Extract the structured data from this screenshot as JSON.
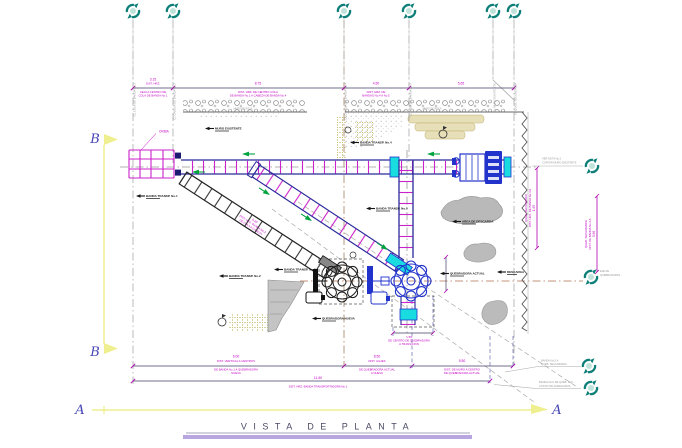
{
  "title": {
    "text": "VISTA  DE  PLANTA"
  },
  "sections": {
    "b_top": "B",
    "b_bottom": "B",
    "a_left": "A",
    "a_right": "A"
  },
  "axes_top": {
    "a0": "CL COLA DE BANDA No.1",
    "a1": "CL CABEZA DE BANDA No.2",
    "a2": "CL CABEZA DE BANDA No.4",
    "a3": "CL COLA DE BANDA No.5",
    "a4": "CL MURO EXISTENTE",
    "a5": "CL QUEB. SECUNDARIA"
  },
  "dims_top": {
    "d0": {
      "value": "3.15",
      "l1": "DIST. HRZ.",
      "l2": "CEJA A CENTRO DE",
      "l3": "COLA DE BANDA No.1"
    },
    "d1": {
      "value": "8.75",
      "l1": "DIST. HRZ. DE CENTRO COLA",
      "l2": "DE BANDA No.1 A CABEZA DE BANDA No.4"
    },
    "d2": {
      "value": "4.50",
      "l1": "DIST. HRZ. DE",
      "l2": "BANDAS No.4 A No.5"
    },
    "d3": {
      "value": "5.65"
    }
  },
  "dims_bottom": {
    "b0": {
      "value": "6.00",
      "l1": "DIST. VERTICAL A CENTROS",
      "l2": "DE BANDA No.1 A QUEBRADORA",
      "l3": "NUEVA"
    },
    "b1": {
      "value": "8.50",
      "l1": "DIST. A EJES",
      "l2": "DE QUEBRADORA ACTUAL",
      "l3": "A NUEVA"
    },
    "b2": {
      "value": "5.50",
      "l1": "DIST. DE MURO A CENTRO",
      "l2": "DE QUEBRADORA ACTUAL"
    },
    "b3": {
      "value": "11.60",
      "l1": "DIST. HRZ. BANDA TRANSPORTADORA No.1"
    }
  },
  "dims_right": {
    "r0": {
      "value": "1.95",
      "l1": "DIST. HRZ. DE BANDA No.4 A",
      "l2": "QUEB. SECUNDARIA"
    },
    "r1": {
      "value": "3.96",
      "l1": "DIST. DE BANDA No.4 A",
      "l2": "QUEB. SECUNDARIA"
    }
  },
  "dim_diag": {
    "value": "9.20",
    "l1": "DIST. HRZ. BANDA No.2",
    "l2": "DE COLA A CABEZA"
  },
  "dim_transition": {
    "value": "1.50",
    "l1": "DE CENTRO DE QUEBRADORA",
    "l2": "A TRANSICION"
  },
  "tags": {
    "t0": "MURO EXISTENTE",
    "t1": "BANDA TRANSP. No.4",
    "t2": "BANDA TRANSP. No.1",
    "t3": "AREA DE DESCARGA",
    "t4": "BANDA TRANSP. No.5",
    "t5": "BANDA TRANSP. No.2",
    "t6": "BANDA TRANSP. No.3",
    "t7": "QUEBRADORA NUEVA",
    "t8": "QUEBRADORA ACTUAL",
    "t9": "DESCARGA"
  },
  "notes": {
    "n0": {
      "l1": "VER NOTA No.2",
      "l2": "CORTAR MURO EXISTENTE"
    },
    "n1": {
      "l1": "EJE DE",
      "l2": "QUEBRADORAS"
    },
    "n2": {
      "l1": "BANDA No.5 A",
      "l2": "QUEB. SECUNDARIA"
    },
    "n3": {
      "l1": "BANDA No.6 DE QUEB. SEC.",
      "l2": "A PATIO DE AGREGADOS"
    }
  },
  "labels": {
    "criba": "CRIBA",
    "roca": "MURO DE ROCA"
  },
  "colors": {
    "magenta": "#cc00cc",
    "navy": "#2a2a9a",
    "teal": "#0e7f78",
    "yellow": "#efef90",
    "cyan": "#18dce0",
    "blue": "#2233cc",
    "lavender": "#b7a6e0"
  }
}
